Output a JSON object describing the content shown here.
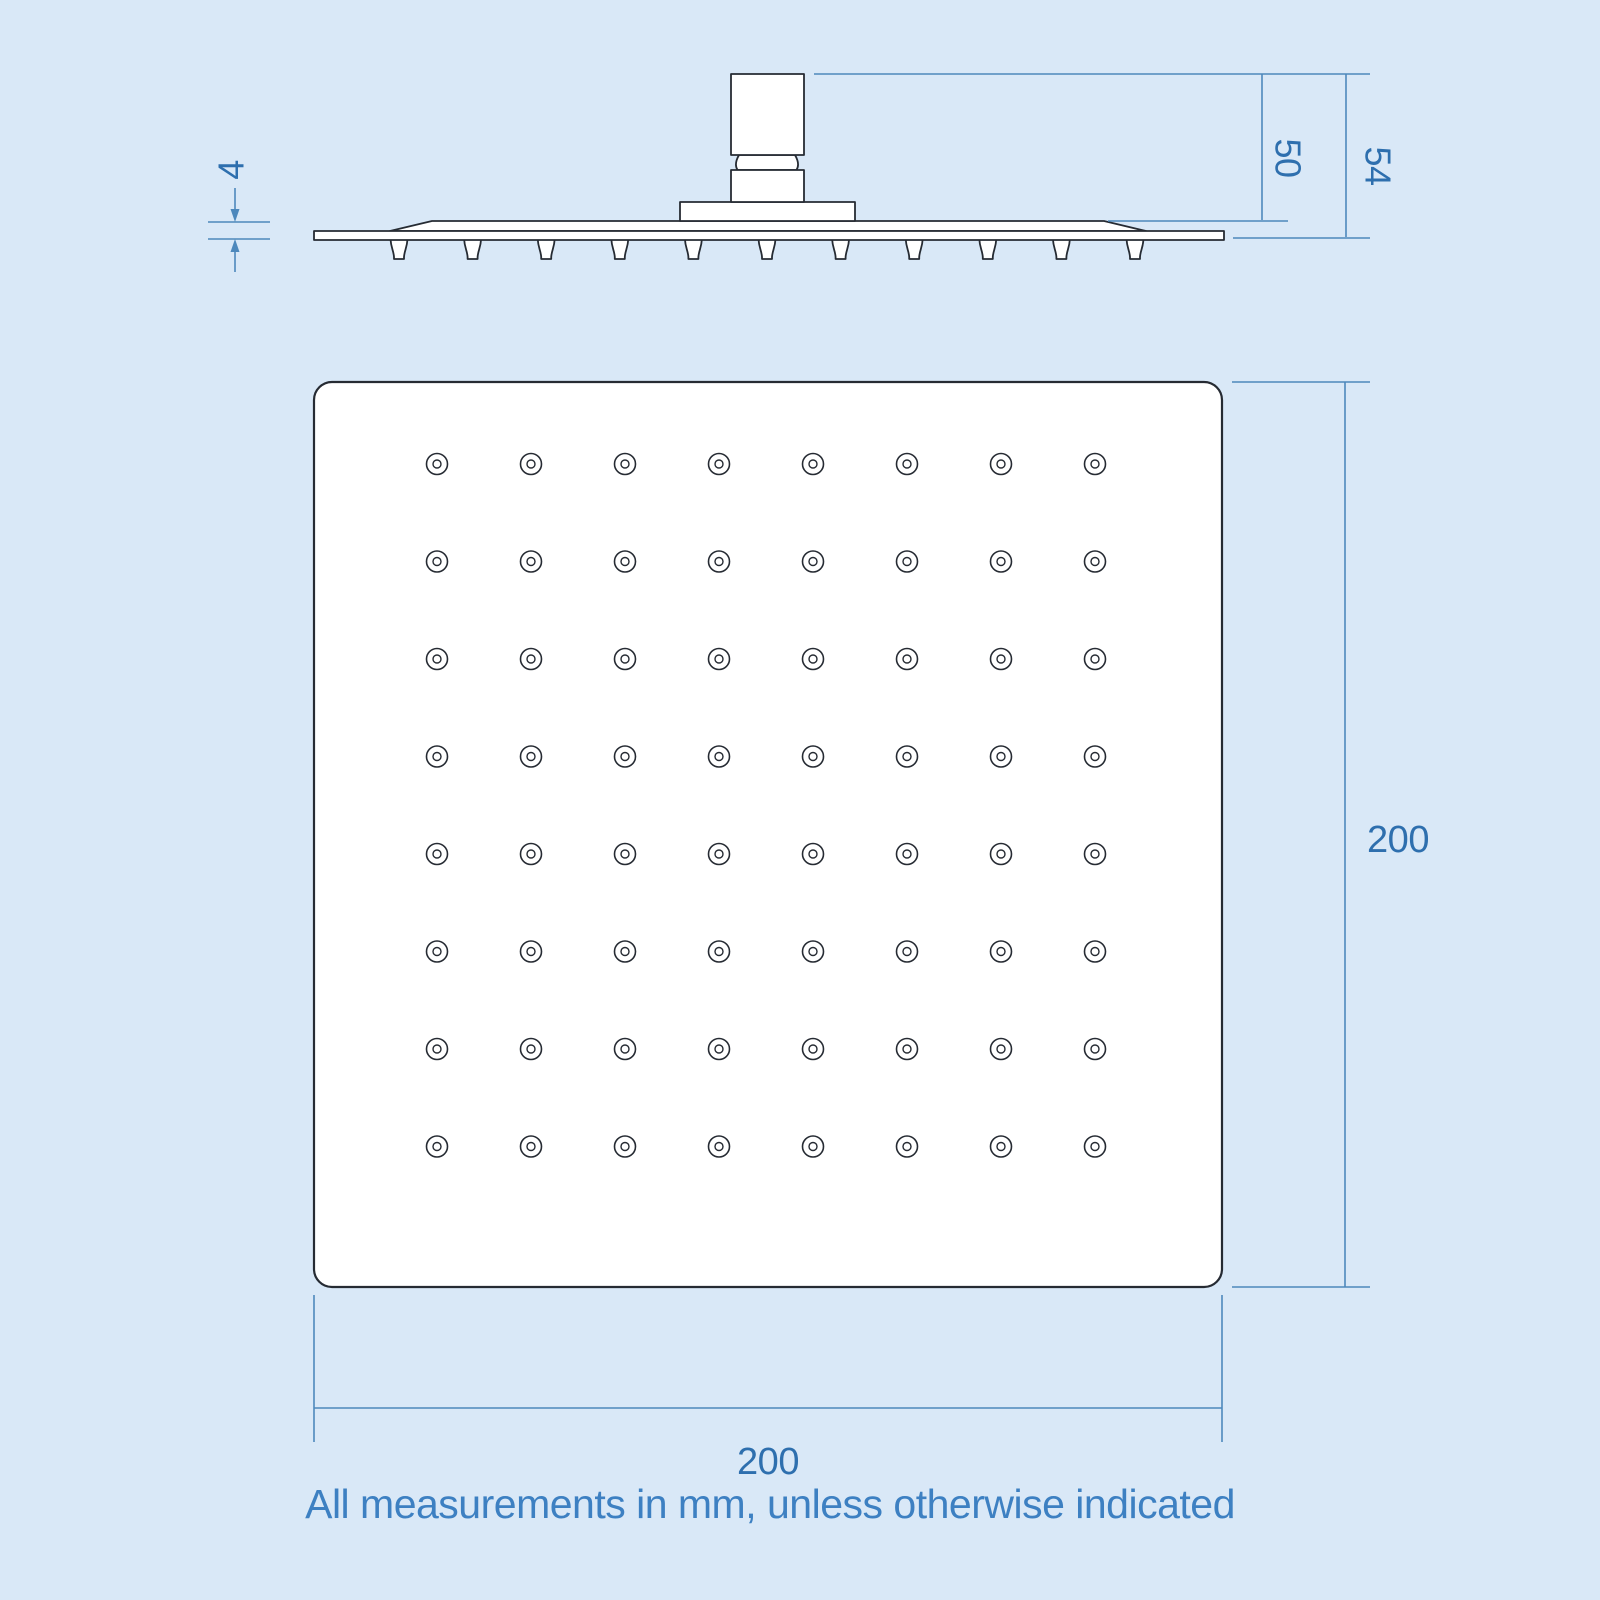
{
  "colors": {
    "background": "#d9e8f7",
    "part_outline": "#262b33",
    "part_fill": "#ffffff",
    "dimension_line": "#4d88bc",
    "dimension_text": "#2e6fae",
    "note_text": "#3d80c2"
  },
  "side_view": {
    "nozzle_count": 11,
    "dimensions": {
      "plate_thickness": "4",
      "connector_to_face": "50",
      "overall_depth": "54"
    }
  },
  "front_view": {
    "hole_rows": 8,
    "hole_cols": 8,
    "dimensions": {
      "height": "200",
      "width": "200"
    }
  },
  "note": "All measurements in mm, unless otherwise indicated"
}
